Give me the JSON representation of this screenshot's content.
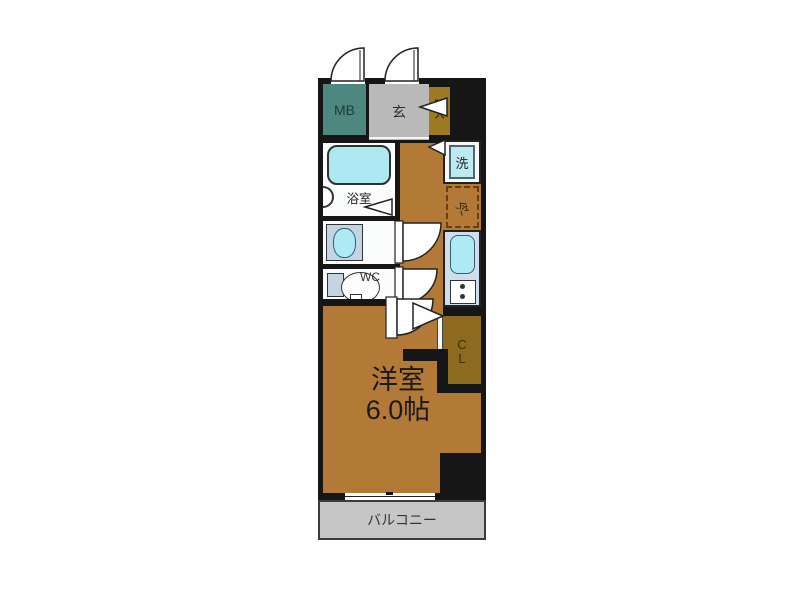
{
  "plan": {
    "mb": {
      "label": "MB"
    },
    "entrance": {
      "label": "玄"
    },
    "shoe_cabinet": {
      "char1": "靴",
      "char2": "入"
    },
    "bathroom": {
      "label": "浴室"
    },
    "washer": {
      "label": "洗"
    },
    "fridge": {
      "label": "冷"
    },
    "wc": {
      "label": "WC"
    },
    "closet": {
      "char1": "C",
      "char2": "L"
    },
    "main_room": {
      "name": "洋室",
      "size": "6.0帖"
    },
    "balcony": {
      "label": "バルコニー"
    }
  },
  "colors": {
    "wall": "#161616",
    "floor_wood": "#b27a36",
    "closet_brown": "#8c6b20",
    "mb_teal": "#4e8680",
    "entrance_gray": "#b9b9b9",
    "shoe_gold": "#9c7a24",
    "balcony_gray": "#c6c6c6",
    "water_cyan": "#aeeaf5",
    "tub_cyan": "#ade8f2",
    "counter_blue": "#cfdeed",
    "fixture_blue": "#c3d5e5",
    "fridge_dash": "#6b3e12"
  }
}
